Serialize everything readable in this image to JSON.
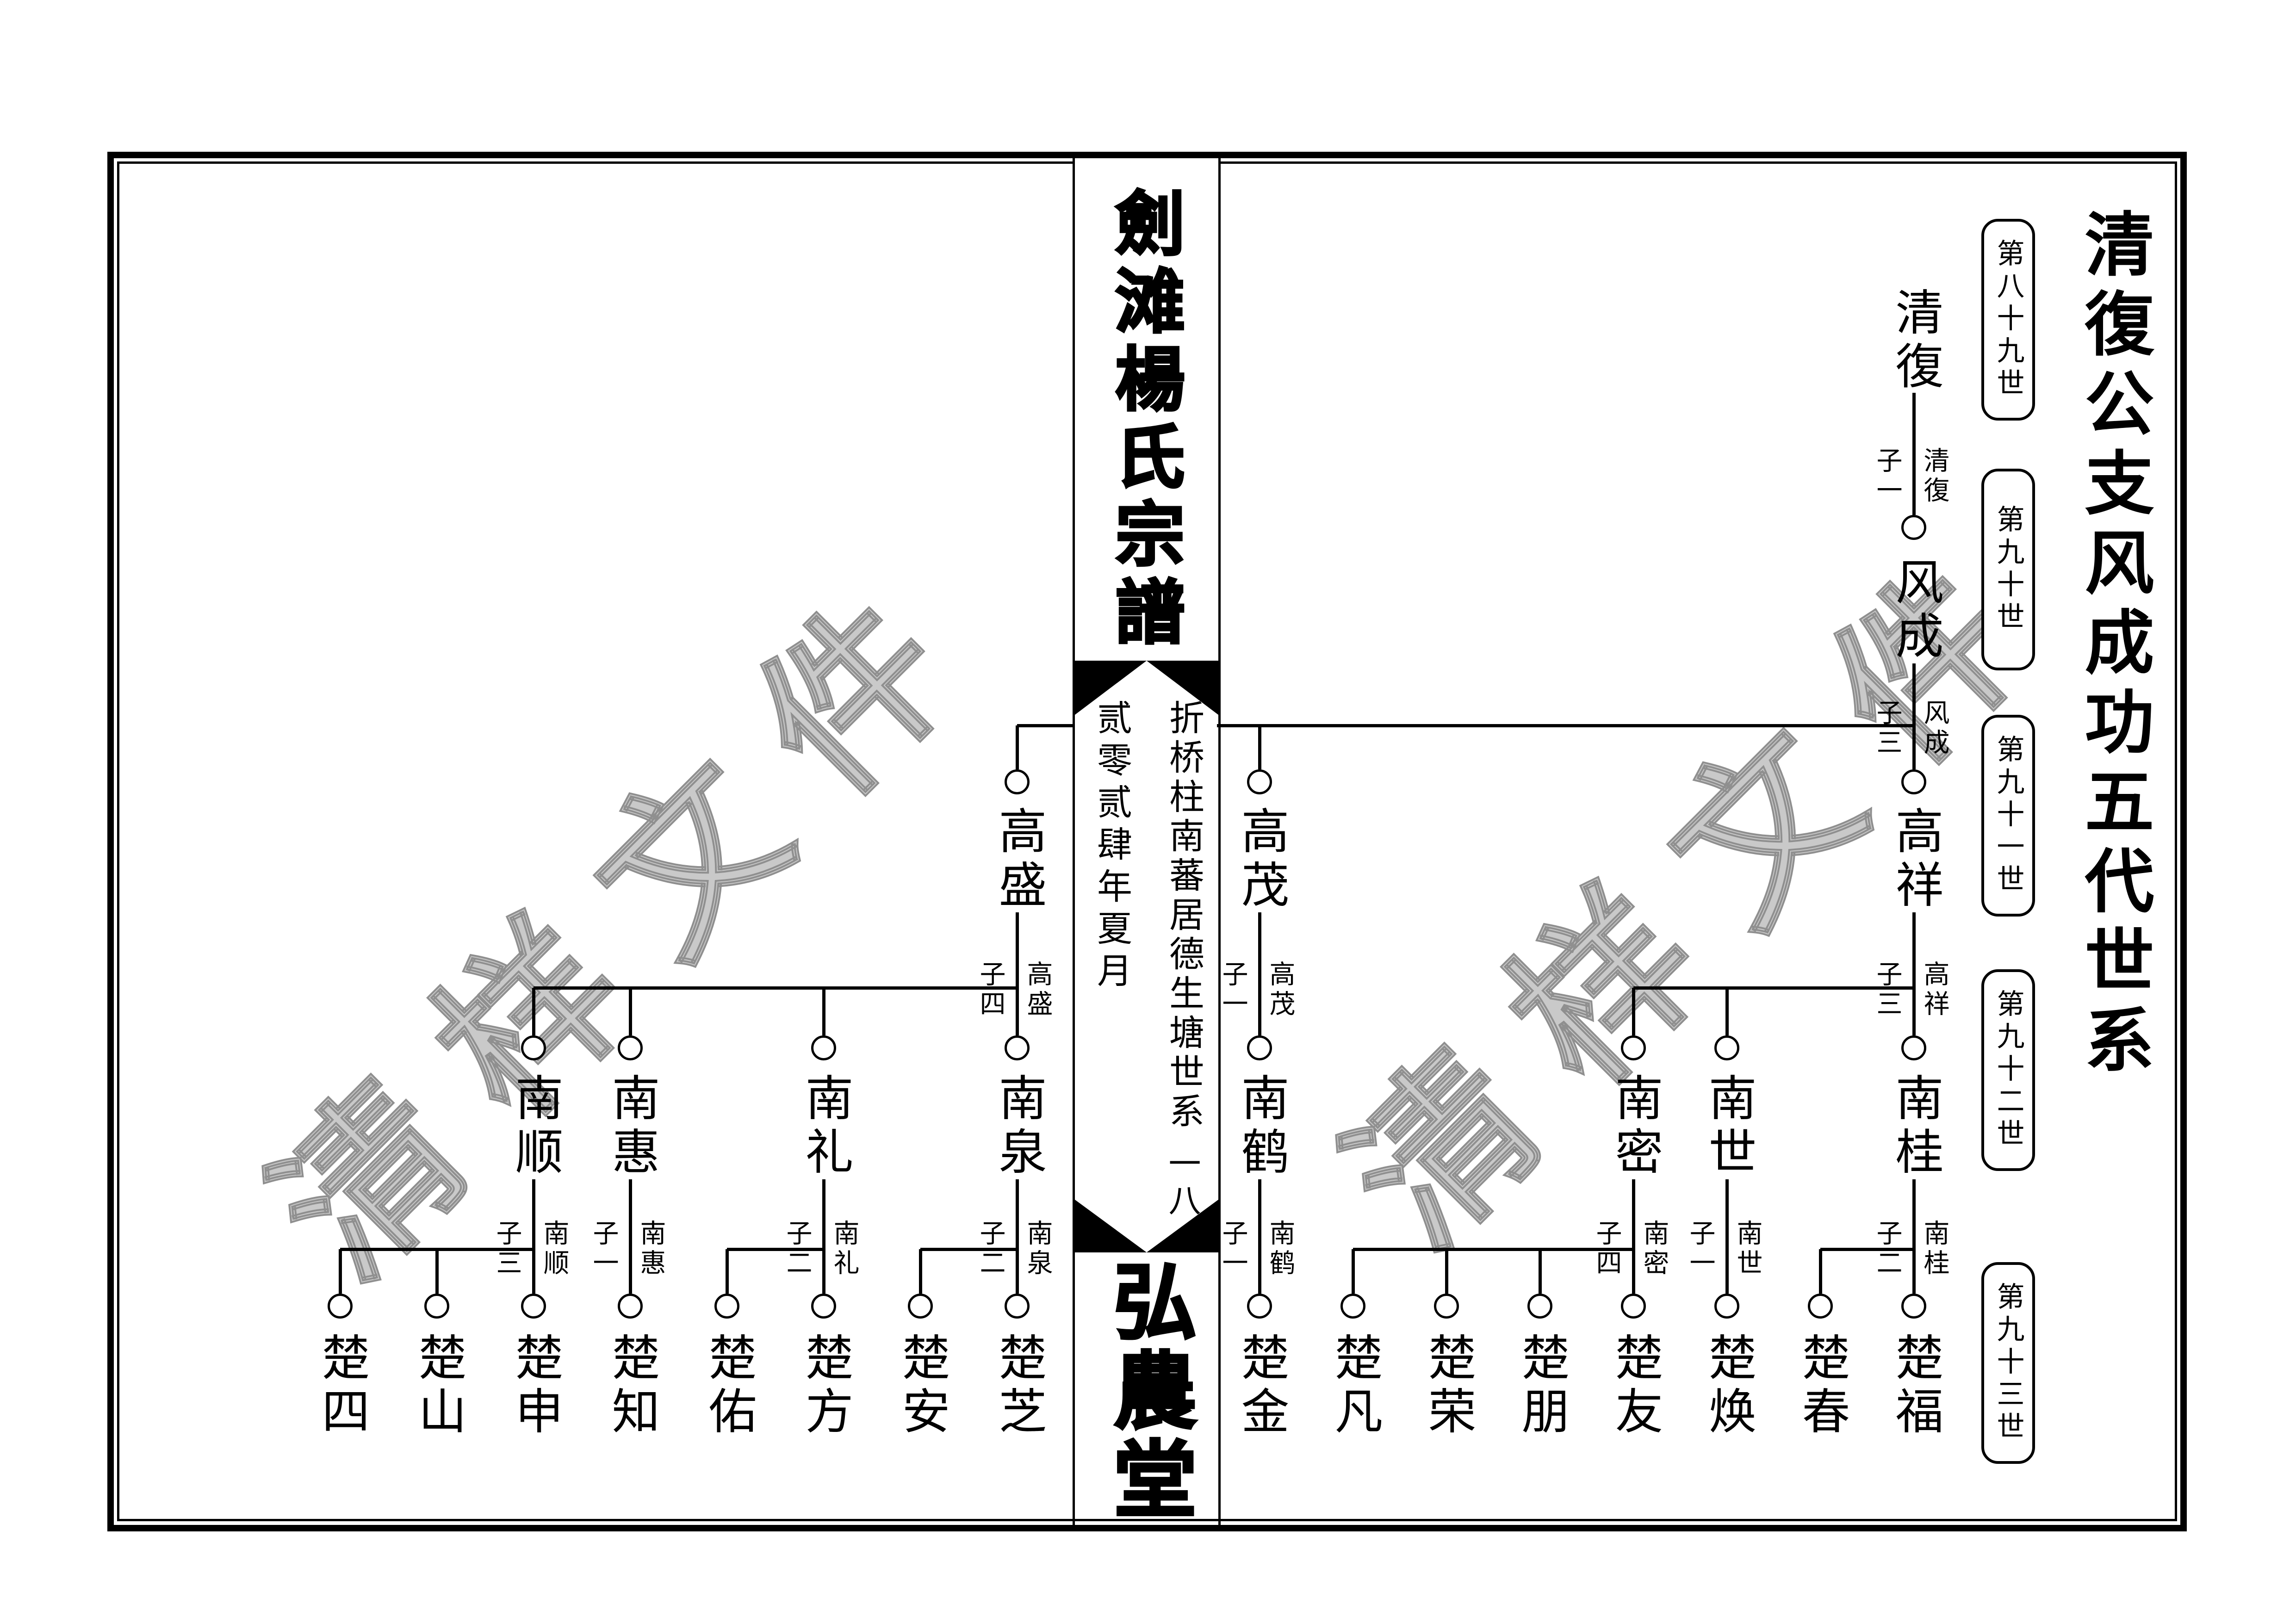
{
  "watermark": {
    "text": "清样文件"
  },
  "right_panel": {
    "title": "清復公支风成功五代世系",
    "generation_labels": [
      "第八十九世",
      "第九十世",
      "第九十一世",
      "第九十二世",
      "第九十三世"
    ]
  },
  "center_strip": {
    "book_title": "劍滩楊氏宗譜",
    "sub_title": "折桥柱南蕃居德生塘世系",
    "date_line": "贰零贰肆年夏月",
    "page_number": "一八",
    "hall_name": "弘農堂"
  },
  "tree": {
    "people": {
      "gen89": [
        "清復"
      ],
      "gen90": [
        "风成"
      ],
      "gen91": [
        "高祥",
        "高茂",
        "高盛"
      ],
      "gen92": [
        "南桂",
        "南世",
        "南密",
        "南鹤",
        "南泉",
        "南礼",
        "南惠",
        "南顺"
      ],
      "gen93": [
        "楚福",
        "楚春",
        "楚焕",
        "楚友",
        "楚朋",
        "楚荣",
        "楚凡",
        "楚金",
        "楚芝",
        "楚安",
        "楚方",
        "楚佑",
        "楚知",
        "楚申",
        "楚山",
        "楚四"
      ]
    },
    "junctions": [
      {
        "sons": "子一",
        "parent": "清復"
      },
      {
        "sons": "子三",
        "parent": "风成"
      },
      {
        "sons": "子三",
        "parent": "高祥"
      },
      {
        "sons": "子一",
        "parent": "高茂"
      },
      {
        "sons": "子四",
        "parent": "高盛"
      },
      {
        "sons": "子二",
        "parent": "南桂"
      },
      {
        "sons": "子一",
        "parent": "南世"
      },
      {
        "sons": "子四",
        "parent": "南密"
      },
      {
        "sons": "子一",
        "parent": "南鹤"
      },
      {
        "sons": "子二",
        "parent": "南泉"
      },
      {
        "sons": "子二",
        "parent": "南礼"
      },
      {
        "sons": "子一",
        "parent": "南惠"
      },
      {
        "sons": "子三",
        "parent": "南顺"
      }
    ]
  }
}
